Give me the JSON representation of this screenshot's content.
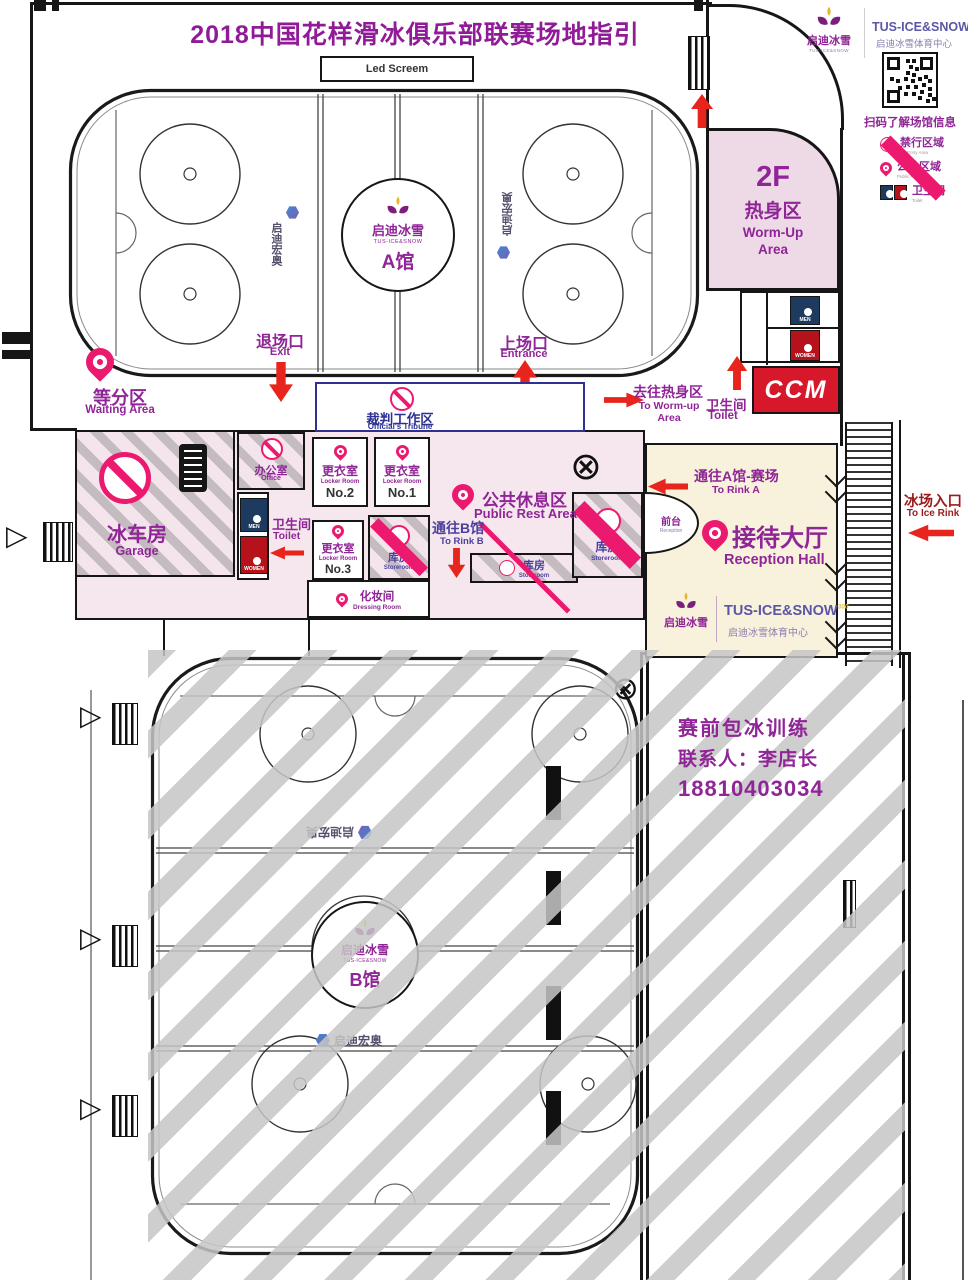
{
  "title": "2018中国花样滑冰俱乐部联赛场地指引",
  "header": {
    "brand_cn": "启迪冰雪",
    "brand_tiny": "TUS-ICE&SNOW",
    "brand_en": "TUS-ICE&SNOW",
    "brand_sup": "300",
    "center_name": "启迪冰雪体育中心",
    "qr_caption": "扫码了解场馆信息",
    "legend": [
      {
        "cn": "禁行区域",
        "en": "No Entry Area",
        "icon": "no-entry-icon"
      },
      {
        "cn": "公共区域",
        "en": "Public Area",
        "icon": "pin-icon"
      },
      {
        "cn": "卫生间",
        "en": "Toilet",
        "icon": "wc-icon"
      }
    ]
  },
  "rink_a": {
    "screen_label": "Led Screem",
    "logo_cn": "启迪冰雪",
    "logo_en": "TUS-ICE&SNOW",
    "hall": "A馆",
    "watermark": "启迪宏奥",
    "waiting_cn": "等分区",
    "waiting_en": "Waiting Area",
    "exit_cn": "退场口",
    "exit_en": "Exit",
    "entrance_cn": "上场口",
    "entrance_en": "Entrance",
    "officials_cn": "裁判工作区",
    "officials_en": "Official's Tribune"
  },
  "mid": {
    "garage_cn": "冰车房",
    "garage_en": "Garage",
    "office_cn": "办公室",
    "office_en": "Office",
    "toilet_cn": "卫生间",
    "toilet_en": "Toilet",
    "locker_cn": "更衣室",
    "locker_en": "Locker Room",
    "no1": "No.1",
    "no2": "No.2",
    "no3": "No.3",
    "rest_cn": "公共休息区",
    "rest_en": "Public Rest Area",
    "store_cn": "库房",
    "store_en": "Storeroom",
    "to_b_cn": "通往B馆",
    "to_b_en": "To Rink B",
    "dressing_cn": "化妆间",
    "dressing_en": "Dressing Room",
    "men": "MEN",
    "women": "WOMEN"
  },
  "right": {
    "floor": "2F",
    "warm_cn": "热身区",
    "warm_en": "Worm-Up Area",
    "to_warm_cn": "去往热身区",
    "to_warm_en": "To Worm-up Area",
    "toilet_cn": "卫生间",
    "toilet_en": "Toilet",
    "ccm": "CCM",
    "desk_cn": "前台",
    "desk_en": "Reception",
    "hall_cn": "接待大厅",
    "hall_en": "Reception Hall",
    "to_a_cn": "通往A馆-赛场",
    "to_a_en": "To Rink A",
    "ice_cn": "冰场入口",
    "ice_en": "To Ice Rink",
    "logo_cn": "启迪冰雪",
    "logo_en": "TUS-ICE&SNOW",
    "logo_sup": "300",
    "logo_sub": "启迪冰雪体育中心"
  },
  "rink_b": {
    "logo_cn": "启迪冰雪",
    "logo_en": "TUS-ICE&SNOW",
    "hall": "B馆",
    "watermark": "启迪宏奥"
  },
  "notice": {
    "l1": "赛前包冰训练",
    "l2": "联系人：李店长",
    "l3": "18810403034"
  },
  "colors": {
    "purple": "#8f2596",
    "pink": "#ec1a6e",
    "red": "#e8251d",
    "blue": "#2e3192",
    "violet": "#4b3f9e",
    "navy": "#1e3a5f",
    "women_red": "#b5121b",
    "ccm_red": "#d7182a",
    "cream": "#f8f1dc",
    "area_pink": "#eedae6",
    "dark_red": "#9b1b1b"
  }
}
